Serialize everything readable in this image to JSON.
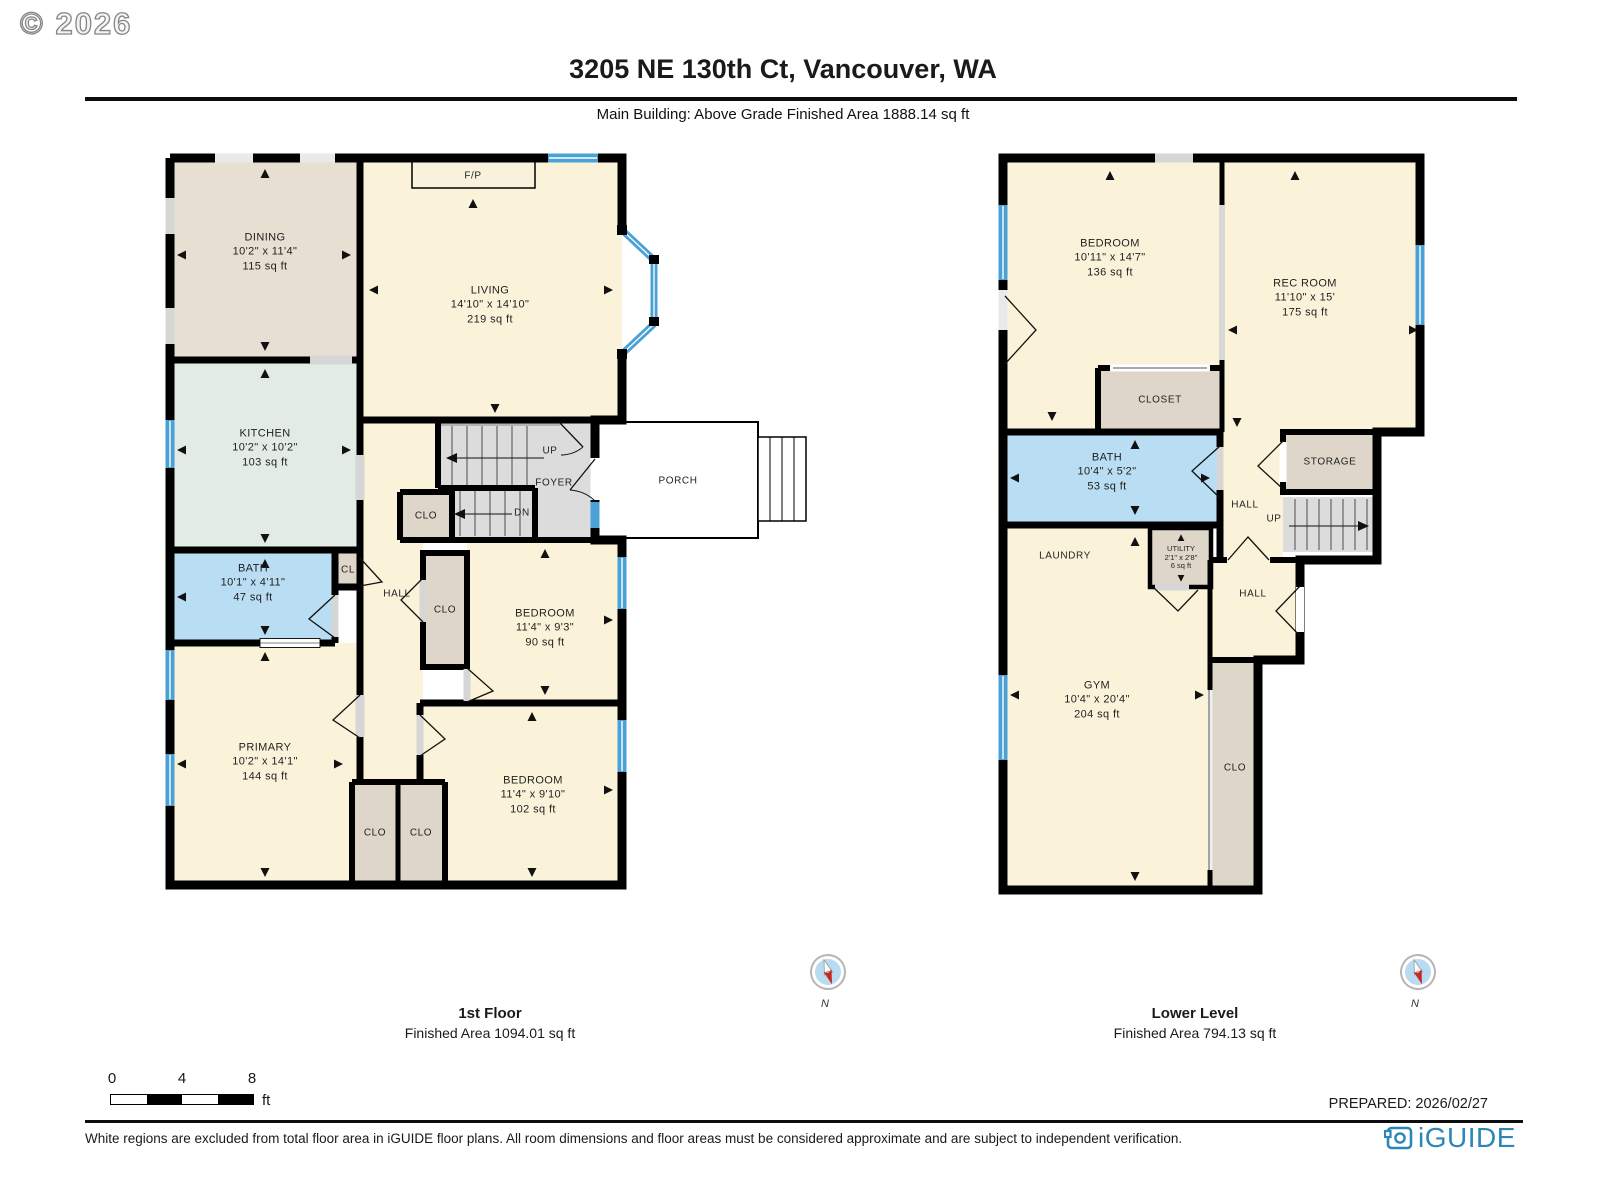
{
  "header": {
    "copyright": "© 2026",
    "title": "3205 NE 130th Ct, Vancouver, WA",
    "subtitle": "Main Building: Above Grade Finished Area 1888.14 sq ft"
  },
  "labels": {
    "fp": "F/P",
    "up": "UP",
    "dn": "DN",
    "foyer": "FOYER",
    "hall": "HALL",
    "cl": "CL",
    "clo": "CLO",
    "porch": "PORCH",
    "closet": "CLOSET",
    "storage": "STORAGE",
    "laundry": "LAUNDRY",
    "north": "N"
  },
  "floor1": {
    "caption": {
      "title": "1st Floor",
      "area": "Finished Area 1094.01 sq ft"
    },
    "rooms": {
      "dining": {
        "name": "DINING",
        "dims": "10'2\" x 11'4\"",
        "area": "115 sq ft"
      },
      "kitchen": {
        "name": "KITCHEN",
        "dims": "10'2\" x 10'2\"",
        "area": "103 sq ft"
      },
      "living": {
        "name": "LIVING",
        "dims": "14'10\" x 14'10\"",
        "area": "219 sq ft"
      },
      "bath": {
        "name": "BATH",
        "dims": "10'1\" x 4'11\"",
        "area": "47 sq ft"
      },
      "primary": {
        "name": "PRIMARY",
        "dims": "10'2\" x 14'1\"",
        "area": "144 sq ft"
      },
      "bedroom1": {
        "name": "BEDROOM",
        "dims": "11'4\" x 9'3\"",
        "area": "90 sq ft"
      },
      "bedroom2": {
        "name": "BEDROOM",
        "dims": "11'4\" x 9'10\"",
        "area": "102 sq ft"
      }
    }
  },
  "floor2": {
    "caption": {
      "title": "Lower Level",
      "area": "Finished Area 794.13 sq ft"
    },
    "rooms": {
      "bedroom": {
        "name": "BEDROOM",
        "dims": "10'11\" x 14'7\"",
        "area": "136 sq ft"
      },
      "recroom": {
        "name": "REC ROOM",
        "dims": "11'10\" x 15'",
        "area": "175 sq ft"
      },
      "bath": {
        "name": "BATH",
        "dims": "10'4\" x 5'2\"",
        "area": "53 sq ft"
      },
      "utility": {
        "name": "UTILITY",
        "dims": "2'1\" x 2'8\"",
        "area": "6 sq ft"
      },
      "gym": {
        "name": "GYM",
        "dims": "10'4\" x 20'4\"",
        "area": "204 sq ft"
      }
    }
  },
  "scalebar": {
    "t0": "0",
    "t4": "4",
    "t8": "8",
    "unit": "ft"
  },
  "prepared": "PREPARED: 2026/02/27",
  "footer_note": "White regions are excluded from total floor area in iGUIDE floor plans. All room dimensions and floor areas must be considered approximate and are subject to independent verification.",
  "brand": "iGUIDE",
  "colors": {
    "wall": "#000000",
    "window": "#4aa1d8",
    "bath": "#b9ddf2",
    "cream": "#fbf3d9",
    "dining": "#e7dfd2",
    "kitchen": "#e3ece4",
    "closet": "#ded7c9",
    "stairs": "#dcdcdc",
    "gap": "#d6d6d6",
    "brand": "#2e86b6",
    "compass_blue": "#b8dbf2",
    "compass_red": "#c8281e"
  }
}
